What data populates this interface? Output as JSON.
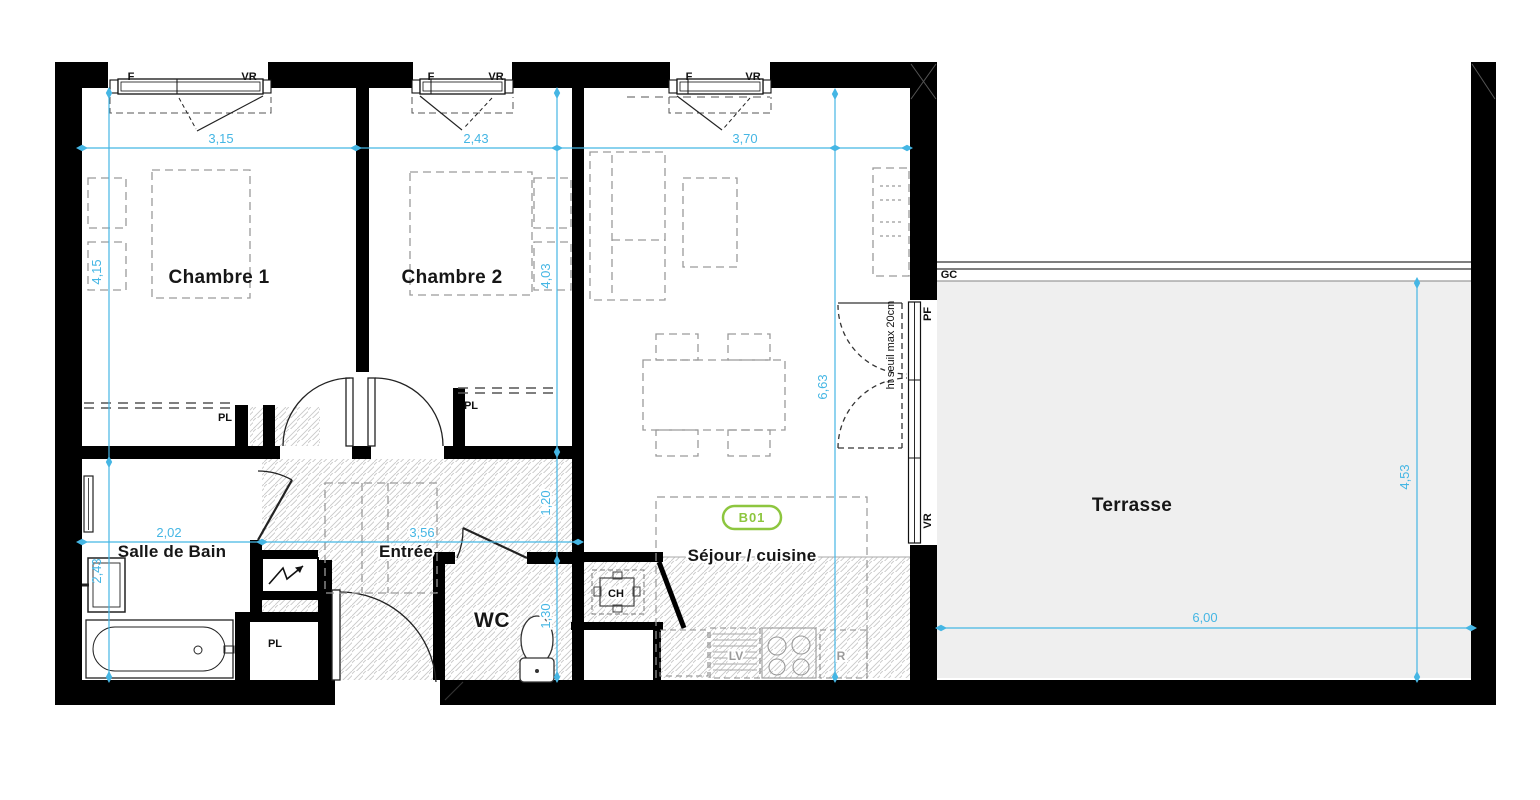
{
  "plan": {
    "unit_badge": "B01",
    "rooms": {
      "chambre1": "Chambre 1",
      "chambre2": "Chambre 2",
      "salle_de_bain": "Salle de Bain",
      "entree": "Entrée",
      "wc": "WC",
      "sejour_cuisine": "Séjour / cuisine",
      "terrasse": "Terrasse"
    },
    "dimensions": {
      "chambre1_width": "3,15",
      "chambre2_width": "2,43",
      "sejour_width": "3,70",
      "chambre1_depth": "4,15",
      "chambre2_depth": "4,03",
      "sejour_depth": "6,63",
      "salle_de_bain_width": "2,02",
      "entree_width": "3,56",
      "salle_de_bain_depth": "2,43",
      "couloir_depth": "1,20",
      "wc_depth": "1,30",
      "terrasse_width": "6,00",
      "terrasse_depth": "4,53"
    },
    "annotations": {
      "fenetre": "F",
      "volet_roulant": "VR",
      "placard": "PL",
      "garde_corps": "GC",
      "porte_fenetre": "PF",
      "chaudiere": "CH",
      "lave_vaisselle": "LV",
      "refrigerateur": "R",
      "seuil_note": "ht seuil max 20cm"
    },
    "colors": {
      "wall": "#000000",
      "dimension": "#45b6e4",
      "badge": "#8dc63f",
      "terrace_fill": "#efefef",
      "hatch": "#c9c9c9"
    }
  }
}
